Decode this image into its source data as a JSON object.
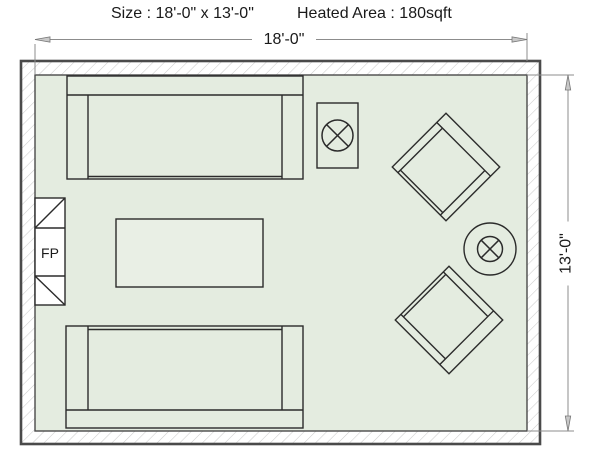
{
  "header": {
    "size_label": "Size : 18'-0\" x 13'-0\"",
    "heated_area_label": "Heated Area : 180sqft"
  },
  "dimensions": {
    "width_label": "18'-0\"",
    "height_label": "13'-0\""
  },
  "floor_plan": {
    "fireplace_label": "FP",
    "colors": {
      "room_fill": "#e4ece0",
      "wall_outline": "#4a4a4a",
      "hatch_line": "#cccccc",
      "furniture_outline": "#2b2b2b",
      "coffee_table_fill": "#e9efe5",
      "fireplace_fill": "#ffffff",
      "dimension_line": "#8c8c8c",
      "text": "#1a1a1a"
    },
    "furniture": [
      {
        "name": "sofa-top"
      },
      {
        "name": "sofa-bottom"
      },
      {
        "name": "coffee-table"
      },
      {
        "name": "side-table-with-table-lamp"
      },
      {
        "name": "armchair-upper-right"
      },
      {
        "name": "armchair-lower-right"
      },
      {
        "name": "round-side-table-with-floor-lamp"
      },
      {
        "name": "fireplace"
      }
    ]
  }
}
